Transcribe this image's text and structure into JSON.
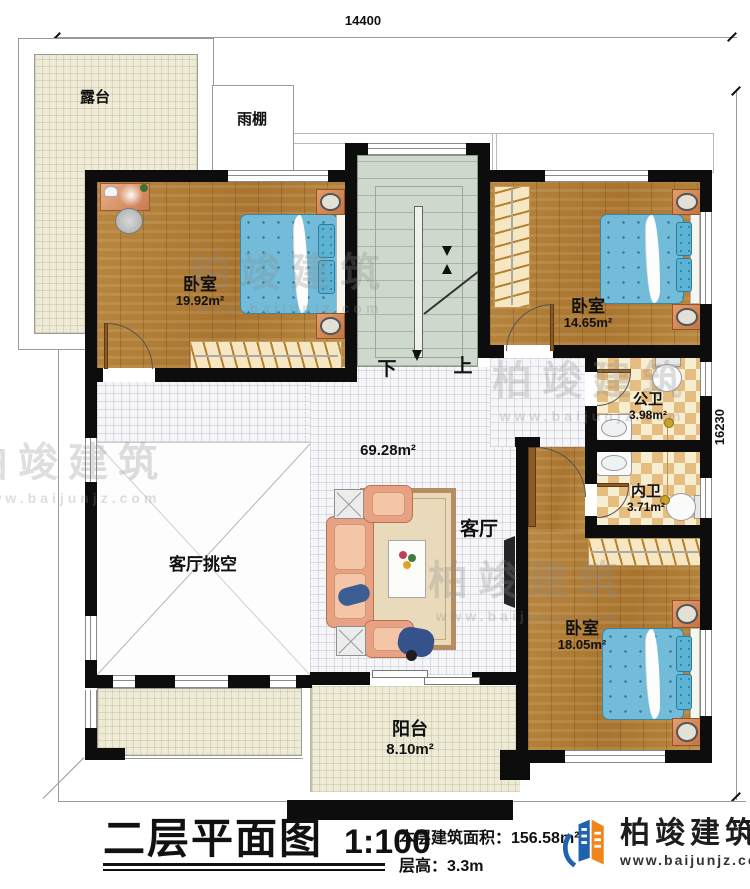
{
  "dimensions": {
    "width": "14400",
    "height": "16230"
  },
  "stairs": {
    "down": "下",
    "up": "上"
  },
  "rooms": {
    "terrace": {
      "label": "露台"
    },
    "canopy": {
      "label": "雨棚"
    },
    "bedroom_left": {
      "label": "卧室",
      "area": "19.92m²"
    },
    "bedroom_top_right": {
      "label": "卧室",
      "area": "14.65m²"
    },
    "bedroom_bottom_right": {
      "label": "卧室",
      "area": "18.05m²"
    },
    "public_bath": {
      "label": "公卫",
      "area": "3.98m²"
    },
    "private_bath": {
      "label": "内卫",
      "area": "3.71m²"
    },
    "living_room": {
      "label": "客厅",
      "area": "69.28m²"
    },
    "living_void": {
      "label": "客厅挑空"
    },
    "balcony": {
      "label": "阳台",
      "area": "8.10m²"
    }
  },
  "title_block": {
    "title": "二层平面图",
    "scale": "1:100",
    "floor_area": "本层建筑面积：156.58m²",
    "floor_height": "层高：3.3m"
  },
  "brand": {
    "name": "柏竣建筑",
    "website": "www.baijunjz.com"
  }
}
